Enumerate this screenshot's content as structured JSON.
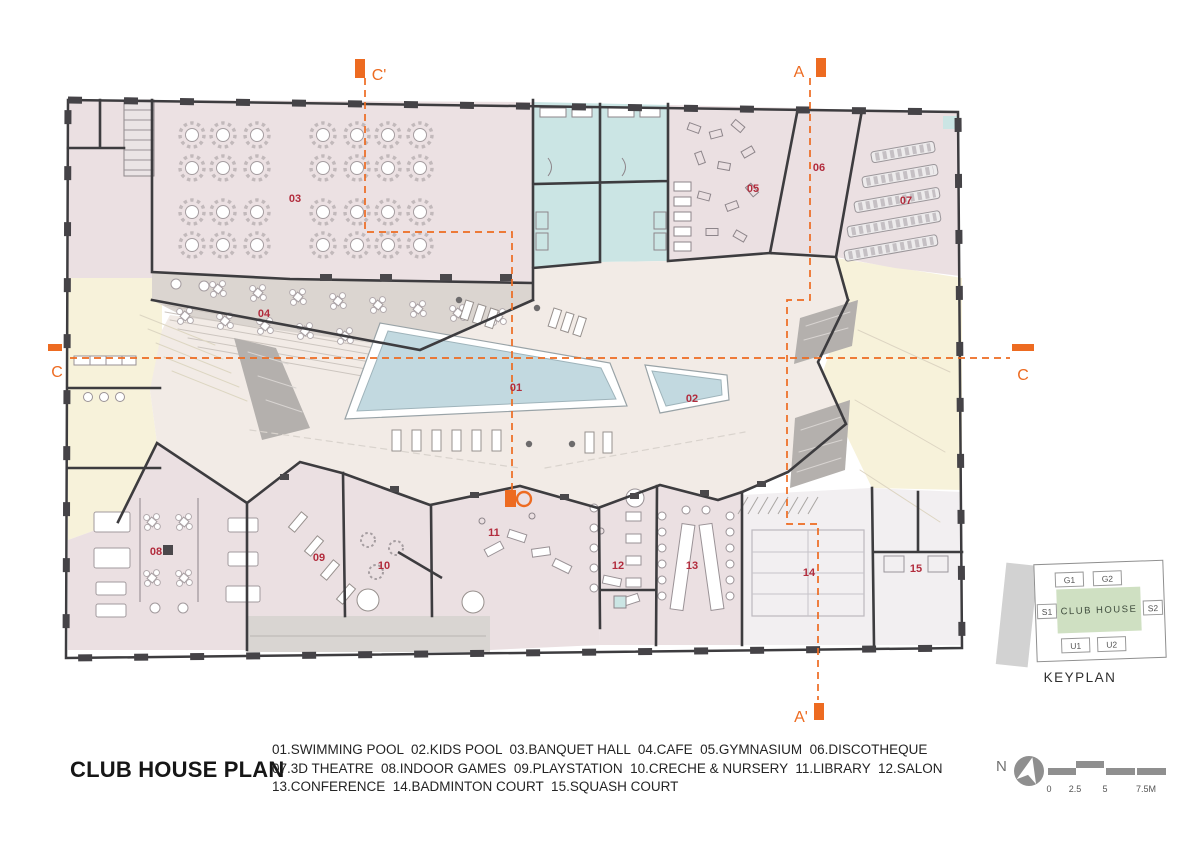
{
  "title": "CLUB HOUSE PLAN",
  "legend": {
    "lines": [
      "01.SWIMMING POOL  02.KIDS POOL  03.BANQUET HALL  04.CAFE  05.GYMNASIUM  06.DISCOTHEQUE",
      "07.3D THEATRE  08.INDOOR GAMES  09.PLAYSTATION  10.CRECHE & NURSERY  11.LIBRARY  12.SALON",
      "13.CONFERENCE  14.BADMINTON COURT  15.SQUASH COURT"
    ]
  },
  "rooms": [
    {
      "num": "01",
      "name": "SWIMMING POOL"
    },
    {
      "num": "02",
      "name": "KIDS POOL"
    },
    {
      "num": "03",
      "name": "BANQUET HALL"
    },
    {
      "num": "04",
      "name": "CAFE"
    },
    {
      "num": "05",
      "name": "GYMNASIUM"
    },
    {
      "num": "06",
      "name": "DISCOTHEQUE"
    },
    {
      "num": "07",
      "name": "3D THEATRE"
    },
    {
      "num": "08",
      "name": "INDOOR GAMES"
    },
    {
      "num": "09",
      "name": "PLAYSTATION"
    },
    {
      "num": "10",
      "name": "CRECHE & NURSERY"
    },
    {
      "num": "11",
      "name": "LIBRARY"
    },
    {
      "num": "12",
      "name": "SALON"
    },
    {
      "num": "13",
      "name": "CONFERENCE"
    },
    {
      "num": "14",
      "name": "BADMINTON COURT"
    },
    {
      "num": "15",
      "name": "SQUASH COURT"
    }
  ],
  "sections": {
    "c_top": "C'",
    "c_left": "C",
    "c_right": "C",
    "a_top": "A",
    "a_bottom": "A'"
  },
  "keyplan": {
    "title": "KEYPLAN",
    "center": "CLUB HOUSE",
    "g1": "G1",
    "g2": "G2",
    "s1": "S1",
    "s2": "S2",
    "u1": "U1",
    "u2": "U2"
  },
  "north_label": "N",
  "scale": {
    "ticks": [
      "0",
      "2.5",
      "5",
      "7.5M"
    ]
  },
  "colors": {
    "accent_orange": "#ed6b21",
    "label_red": "#b22c3d",
    "wall": "#3d3c3f",
    "pool_blue": "#c2d9e0",
    "room_pink": "#ebe0e2",
    "teal": "#cbe5e4",
    "yellow": "#f7f2da",
    "deck": "#f2ebe6",
    "cafe_gray": "#dbd5d0",
    "keyplan_green": "#cfe0c2"
  }
}
